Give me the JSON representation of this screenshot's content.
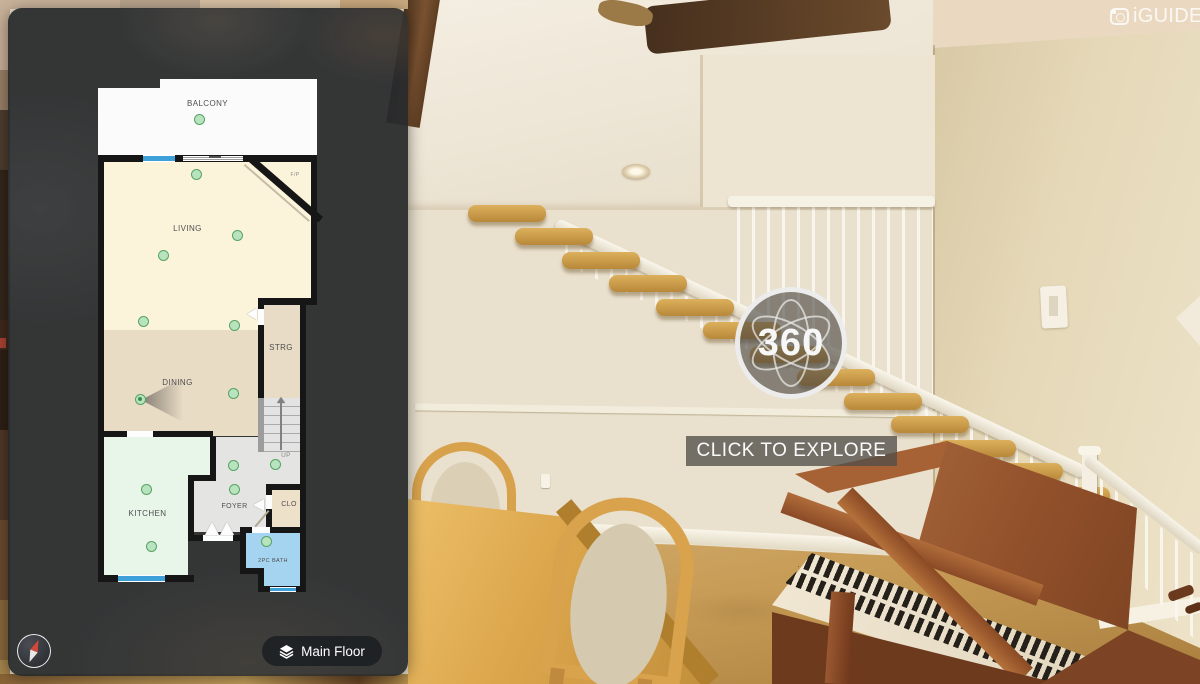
{
  "app": {
    "logo_text": "iGUIDE"
  },
  "pano": {
    "badge_text": "360",
    "explore_label": "CLICK TO EXPLORE"
  },
  "controls": {
    "floor_label": "Main Floor"
  },
  "plan": {
    "rooms": [
      {
        "label": "BALCONY"
      },
      {
        "label": "LIVING"
      },
      {
        "label": "DINING"
      },
      {
        "label": "STRG"
      },
      {
        "label": "KITCHEN"
      },
      {
        "label": "FOYER"
      },
      {
        "label": "CLO"
      },
      {
        "label": "2PC BATH"
      }
    ],
    "stairs_label": "UP",
    "fireplace_label": "F/P",
    "camera_point_count": 14,
    "colors": {
      "wall": "#161616",
      "balcony": "#fbfbfb",
      "living": "#fcf4da",
      "dining": "#e9dcc5",
      "storage": "#e9dcc6",
      "kitchen": "#e8f5e9",
      "foyer": "#e4e4e2",
      "closet": "#eee1ca",
      "bath": "#a5d4f0",
      "window": "#3ea0d8",
      "camera_point": "#b7e4bf",
      "camera_point_border": "#57a263"
    }
  }
}
